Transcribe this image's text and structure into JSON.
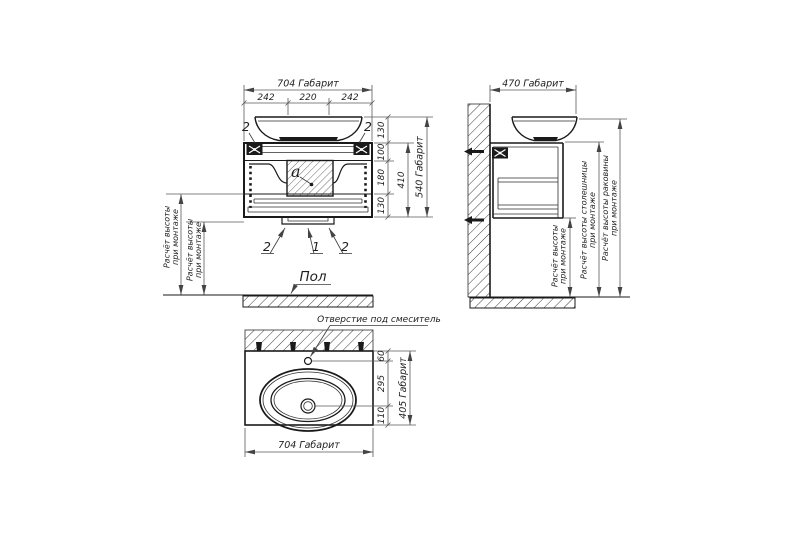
{
  "drawing_title": "Схема монтажа тумбы с раковиной",
  "colors": {
    "background": "#ffffff",
    "object_line": "#1a1a1a",
    "dimension_line": "#5a5a5a",
    "text": "#1f1f1f"
  },
  "front_view": {
    "dim_width_total": "704 Габарит",
    "dim_width_left": "242",
    "dim_width_center": "220",
    "dim_width_right": "242",
    "dim_sink_height": "130",
    "dim_top_section": "100",
    "dim_middle_section": "180",
    "dim_bottom_section": "130",
    "dim_cabinet_height": "410",
    "dim_height_total": "540 Габарит",
    "callout_top_left": "2",
    "callout_top_right": "2",
    "callout_bottom_left": "2",
    "callout_bottom_center": "1",
    "callout_bottom_right": "2",
    "detail_label": "a",
    "floor_label": "Пол",
    "mount_note": {
      "line1": "Расчёт высоты",
      "line2": "при монтаже"
    }
  },
  "side_view": {
    "dim_depth_total": "470 Габарит",
    "note_height": {
      "line1": "Расчёт высоты",
      "line2": "при монтаже"
    },
    "note_countertop": {
      "line1": "Расчёт высоты столешницы",
      "line2": "при монтаже"
    },
    "note_sink": {
      "line1": "Расчёт высоты раковины",
      "line2": "при монтаже"
    }
  },
  "top_view": {
    "faucet_hole_label": "Отверстие под смеситель",
    "dim_faucet_offset": "60",
    "dim_drain_offset": "295",
    "dim_front_offset": "110",
    "dim_depth_total": "405 Габарит",
    "dim_width_total": "704 Габарит"
  }
}
